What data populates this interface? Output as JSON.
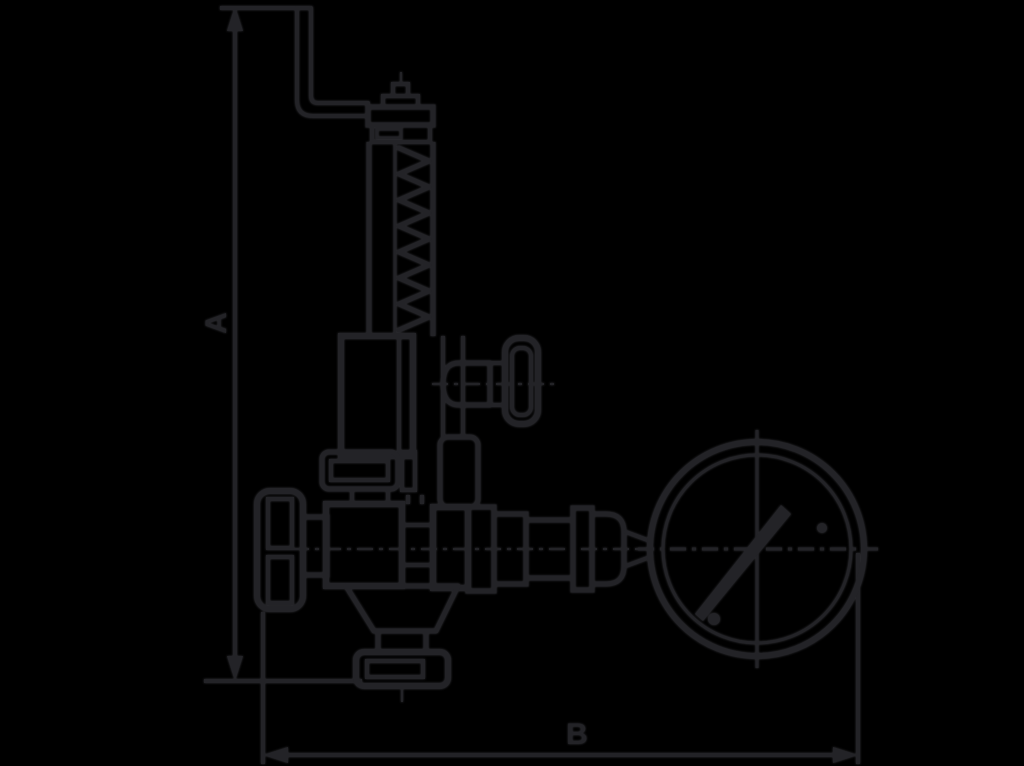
{
  "diagram": {
    "labels": {
      "dimension_vertical": "A",
      "dimension_horizontal": "B"
    },
    "colors": {
      "background": "#000000",
      "line": "#232327",
      "halo": "#36363b"
    }
  }
}
